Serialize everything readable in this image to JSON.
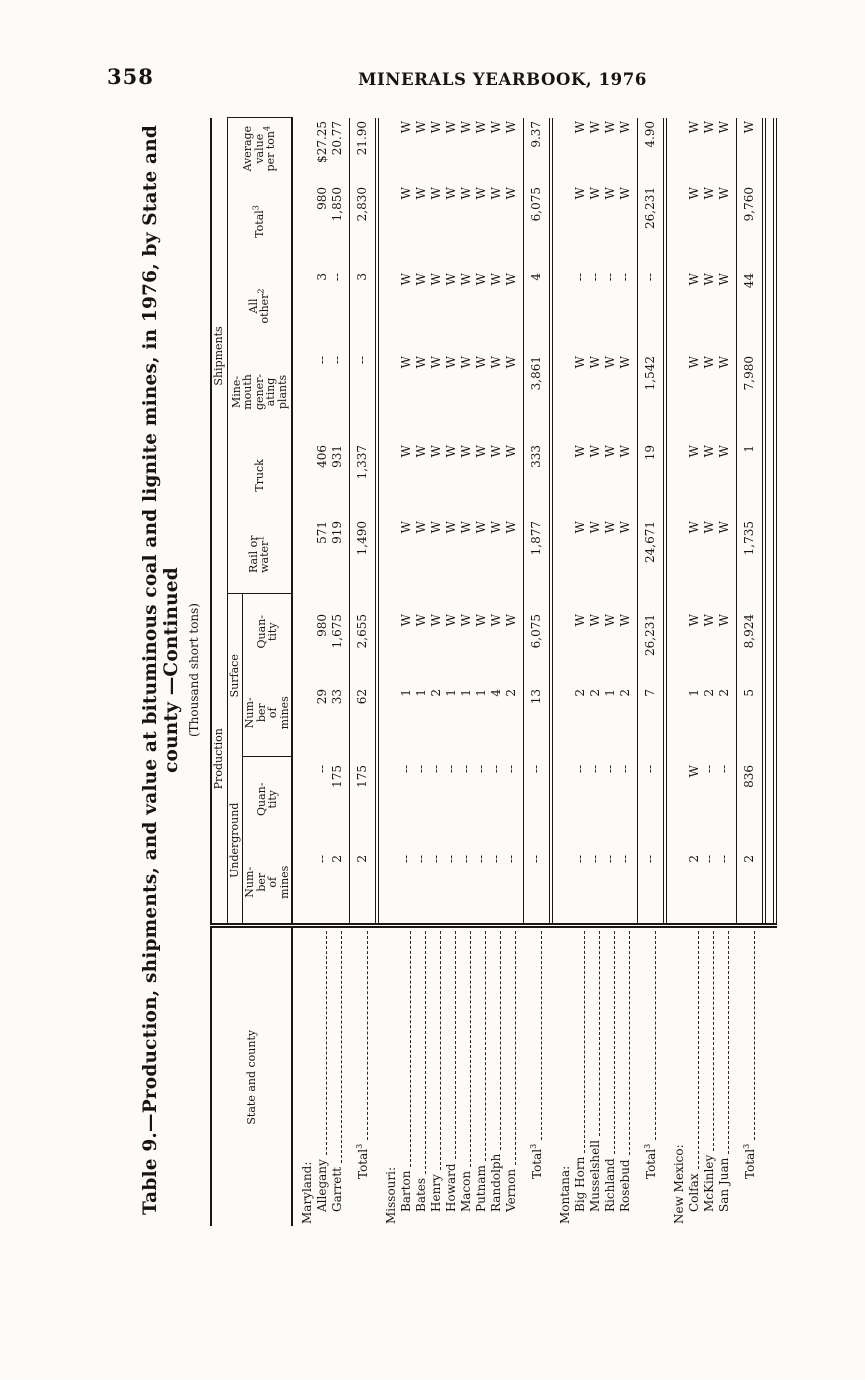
{
  "page": {
    "number": "358",
    "running_head": "MINERALS YEARBOOK, 1976"
  },
  "table": {
    "title": "Table 9.—Production, shipments, and value at bituminous coal and lignite mines, in 1976, by State and county —Continued",
    "subtitle": "(Thousand short tons)",
    "stub_header": "State and county",
    "header": {
      "production": "Production",
      "shipments": "Shipments",
      "underground": "Underground",
      "surface": "Surface",
      "leaf": {
        "number_of_mines": [
          "Num-",
          "ber",
          "of",
          "mines"
        ],
        "quantity": [
          "Quan-",
          "tity"
        ],
        "rail_or_water": [
          "Rail or",
          "water^1"
        ],
        "truck": [
          "Truck"
        ],
        "mine_mouth": [
          "Mine-",
          "mouth",
          "gener-",
          "ating",
          "plants"
        ],
        "all_other": [
          "All",
          "other^2"
        ],
        "total": [
          "Total^3"
        ],
        "average_value": [
          "Average",
          "value",
          "per ton^4"
        ]
      }
    },
    "withheld_symbol": "W",
    "null_symbol": "--",
    "rows": [
      {
        "type": "state",
        "label": "Maryland:"
      },
      {
        "type": "county",
        "label": "Allegany",
        "cells": [
          "--",
          "--",
          "29",
          "980",
          "571",
          "406",
          "--",
          "3",
          "980",
          "$27.25"
        ]
      },
      {
        "type": "county",
        "label": "Garrett",
        "last": true,
        "cells": [
          "2",
          "175",
          "33",
          "1,675",
          "919",
          "931",
          "--",
          "--",
          "1,850",
          "20.77"
        ]
      },
      {
        "type": "total",
        "label": "Total^3",
        "cells": [
          "2",
          "175",
          "62",
          "2,655",
          "1,490",
          "1,337",
          "--",
          "3",
          "2,830",
          "21.90"
        ]
      },
      {
        "type": "state",
        "label": "Missouri:"
      },
      {
        "type": "county",
        "label": "Barton",
        "cells": [
          "--",
          "--",
          "1",
          "W",
          "W",
          "W",
          "W",
          "W",
          "W",
          "W"
        ]
      },
      {
        "type": "county",
        "label": "Bates",
        "cells": [
          "--",
          "--",
          "1",
          "W",
          "W",
          "W",
          "W",
          "W",
          "W",
          "W"
        ]
      },
      {
        "type": "county",
        "label": "Henry",
        "cells": [
          "--",
          "--",
          "2",
          "W",
          "W",
          "W",
          "W",
          "W",
          "W",
          "W"
        ]
      },
      {
        "type": "county",
        "label": "Howard",
        "cells": [
          "--",
          "--",
          "1",
          "W",
          "W",
          "W",
          "W",
          "W",
          "W",
          "W"
        ]
      },
      {
        "type": "county",
        "label": "Macon",
        "cells": [
          "--",
          "--",
          "1",
          "W",
          "W",
          "W",
          "W",
          "W",
          "W",
          "W"
        ]
      },
      {
        "type": "county",
        "label": "Putnam",
        "cells": [
          "--",
          "--",
          "1",
          "W",
          "W",
          "W",
          "W",
          "W",
          "W",
          "W"
        ]
      },
      {
        "type": "county",
        "label": "Randolph",
        "cells": [
          "--",
          "--",
          "4",
          "W",
          "W",
          "W",
          "W",
          "W",
          "W",
          "W"
        ]
      },
      {
        "type": "county",
        "label": "Vernon",
        "last": true,
        "cells": [
          "--",
          "--",
          "2",
          "W",
          "W",
          "W",
          "W",
          "W",
          "W",
          "W"
        ]
      },
      {
        "type": "total",
        "label": "Total^3",
        "cells": [
          "--",
          "--",
          "13",
          "6,075",
          "1,877",
          "333",
          "3,861",
          "4",
          "6,075",
          "9.37"
        ]
      },
      {
        "type": "state",
        "label": "Montana:"
      },
      {
        "type": "county",
        "label": "Big Horn",
        "cells": [
          "--",
          "--",
          "2",
          "W",
          "W",
          "W",
          "W",
          "--",
          "W",
          "W"
        ]
      },
      {
        "type": "county",
        "label": "Musselshell",
        "cells": [
          "--",
          "--",
          "2",
          "W",
          "W",
          "W",
          "W",
          "--",
          "W",
          "W"
        ]
      },
      {
        "type": "county",
        "label": "Richland",
        "cells": [
          "--",
          "--",
          "1",
          "W",
          "W",
          "W",
          "W",
          "--",
          "W",
          "W"
        ]
      },
      {
        "type": "county",
        "label": "Rosebud",
        "last": true,
        "cells": [
          "--",
          "--",
          "2",
          "W",
          "W",
          "W",
          "W",
          "--",
          "W",
          "W"
        ]
      },
      {
        "type": "total",
        "label": "Total^3",
        "cells": [
          "--",
          "--",
          "7",
          "26,231",
          "24,671",
          "19",
          "1,542",
          "--",
          "26,231",
          "4.90"
        ]
      },
      {
        "type": "state",
        "label": "New Mexico:"
      },
      {
        "type": "county",
        "label": "Colfax",
        "cells": [
          "2",
          "W",
          "1",
          "W",
          "W",
          "W",
          "W",
          "W",
          "W",
          "W"
        ]
      },
      {
        "type": "county",
        "label": "McKinley",
        "cells": [
          "--",
          "--",
          "2",
          "W",
          "W",
          "W",
          "W",
          "W",
          "W",
          "W"
        ]
      },
      {
        "type": "county",
        "label": "San Juan",
        "last": true,
        "cells": [
          "--",
          "--",
          "2",
          "W",
          "W",
          "W",
          "W",
          "W",
          "W",
          "W"
        ]
      },
      {
        "type": "total",
        "label": "Total^3",
        "cells": [
          "2",
          "836",
          "5",
          "8,924",
          "1,735",
          "1",
          "7,980",
          "44",
          "9,760",
          "W"
        ]
      }
    ]
  }
}
